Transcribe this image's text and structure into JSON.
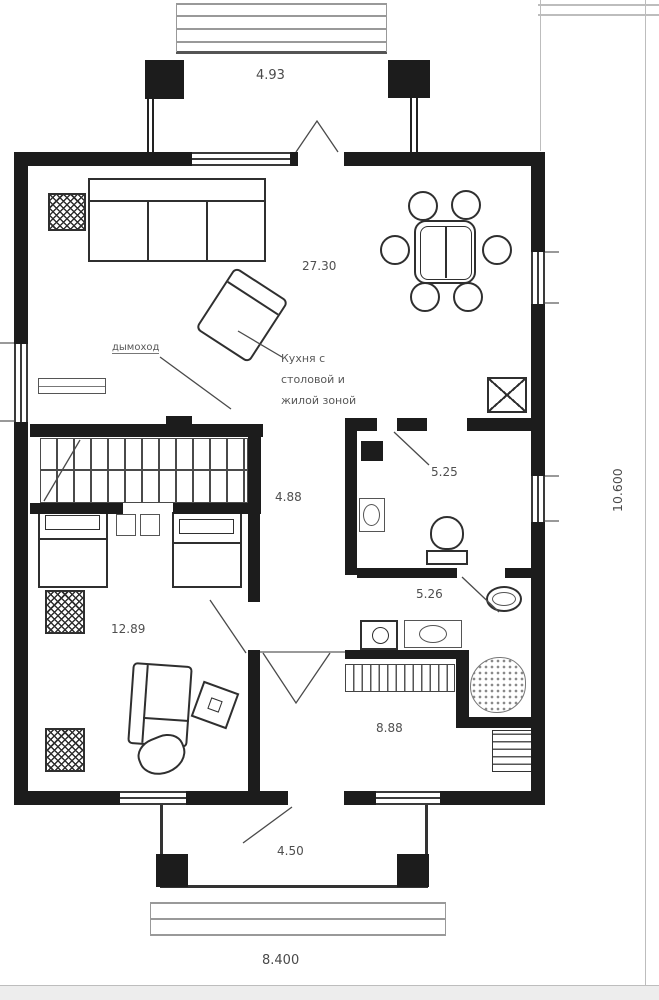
{
  "plan": {
    "areas": {
      "kitchen_living": "27.30",
      "hall": "4.88",
      "wc": "5.25",
      "bathroom": "5.26",
      "bedroom": "12.89",
      "entry_hall": "8.88",
      "porch": "4.50"
    },
    "room_label": {
      "line1": "Кухня с",
      "line2": "столовой и",
      "line3": "жилой зоной"
    },
    "callout": "дымоход",
    "dimensions": {
      "entry_width": "4.93",
      "overall_width": "8.400",
      "overall_depth": "10.600"
    },
    "colors": {
      "wall": "#1c1c1c",
      "line": "#555555",
      "dim_text": "#4f4f4f"
    }
  }
}
